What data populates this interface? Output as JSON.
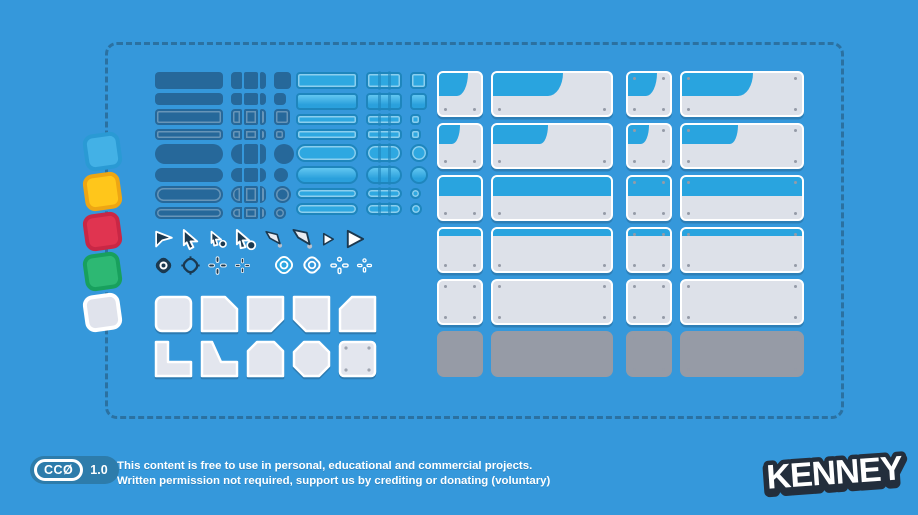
{
  "page": {
    "background": "#3598db",
    "frame_dash_color": "#2b71a1"
  },
  "swatches": [
    {
      "name": "blue",
      "fill": "#43b1e6",
      "border": "#2a9ad4"
    },
    {
      "name": "yellow",
      "fill": "#ffc61b",
      "border": "#eea613"
    },
    {
      "name": "red",
      "fill": "#e03450",
      "border": "#c92745"
    },
    {
      "name": "green",
      "fill": "#2db873",
      "border": "#18a05d"
    },
    {
      "name": "white",
      "fill": "#e0e3ec",
      "border": "#ffffff"
    }
  ],
  "colors": {
    "dark_button": "#26689a",
    "light_button_fill": "#2ea8e1",
    "light_button_border": "#1e86bd",
    "panel_header": "#29a4df",
    "panel_body": "#dde1e9",
    "panel_border": "#ffffff",
    "panel_grey": "#969ba6",
    "cursor_dark": "#1b3950",
    "cursor_light": "#ffffff"
  },
  "button_columns": [
    {
      "name": "dark-buttons",
      "theme": "dark",
      "bar_w": 68,
      "seg": "pieces",
      "rows": [
        {
          "h": 17,
          "kind": "rect",
          "variant": "solid"
        },
        {
          "h": 12,
          "kind": "rect",
          "variant": "solid"
        },
        {
          "h": 16,
          "kind": "rect",
          "variant": "outline"
        },
        {
          "h": 11,
          "kind": "rect",
          "variant": "outline"
        },
        {
          "h": 20,
          "kind": "pill",
          "variant": "solid"
        },
        {
          "h": 14,
          "kind": "pill",
          "variant": "solid"
        },
        {
          "h": 17,
          "kind": "pill",
          "variant": "outline"
        },
        {
          "h": 12,
          "kind": "pill",
          "variant": "outline"
        }
      ]
    },
    {
      "name": "light-buttons",
      "theme": "light",
      "bar_w": 62,
      "seg": "divided",
      "rows": [
        {
          "h": 17,
          "kind": "rect",
          "variant": "outline"
        },
        {
          "h": 17,
          "kind": "rect",
          "variant": "bevel"
        },
        {
          "h": 11,
          "kind": "rect",
          "variant": "outline"
        },
        {
          "h": 11,
          "kind": "rect",
          "variant": "outline"
        },
        {
          "h": 18,
          "kind": "pill",
          "variant": "outline"
        },
        {
          "h": 18,
          "kind": "pill",
          "variant": "bevel"
        },
        {
          "h": 11,
          "kind": "pill",
          "variant": "outline"
        },
        {
          "h": 12,
          "kind": "pill",
          "variant": "outline"
        }
      ]
    }
  ],
  "icons": {
    "cursors": [
      "cursor-flag",
      "cursor-arrow",
      "cursor-arrow-dot-small",
      "cursor-arrow-dot",
      "cursor-kite-small",
      "cursor-kite",
      "cursor-triangle-small",
      "cursor-triangle"
    ],
    "crosshairs": [
      "crosshair-ring-solid-dark",
      "crosshair-ring-outline-dark",
      "crosshair-plus-dark",
      "crosshair-plus-small-dark",
      "crosshair-ring-solid-light",
      "crosshair-ring-outline-light",
      "crosshair-plus-light",
      "crosshair-plus-small-light"
    ]
  },
  "white_shapes": [
    "rounded-square",
    "chamfer-top-right",
    "chamfer-bottom-right",
    "chamfer-bottom-left",
    "chamfer-top-left",
    "l-shape",
    "ramp",
    "chamfer-top-both",
    "octagon",
    "square-screws"
  ],
  "panels": {
    "row_types": [
      "tab-large",
      "tab-small",
      "header-half",
      "header-strip",
      "plain",
      "grey"
    ],
    "columns": [
      "small",
      "wide",
      "small-screws",
      "wide-screws"
    ]
  },
  "footer": {
    "badge": {
      "license": "CCØ",
      "version": "1.0"
    },
    "line1": "This content is free to use in personal, educational and commercial projects.",
    "line2": "Written permission not required, support us by crediting or donating (voluntary)"
  },
  "logo": {
    "text": "KENNEY"
  }
}
